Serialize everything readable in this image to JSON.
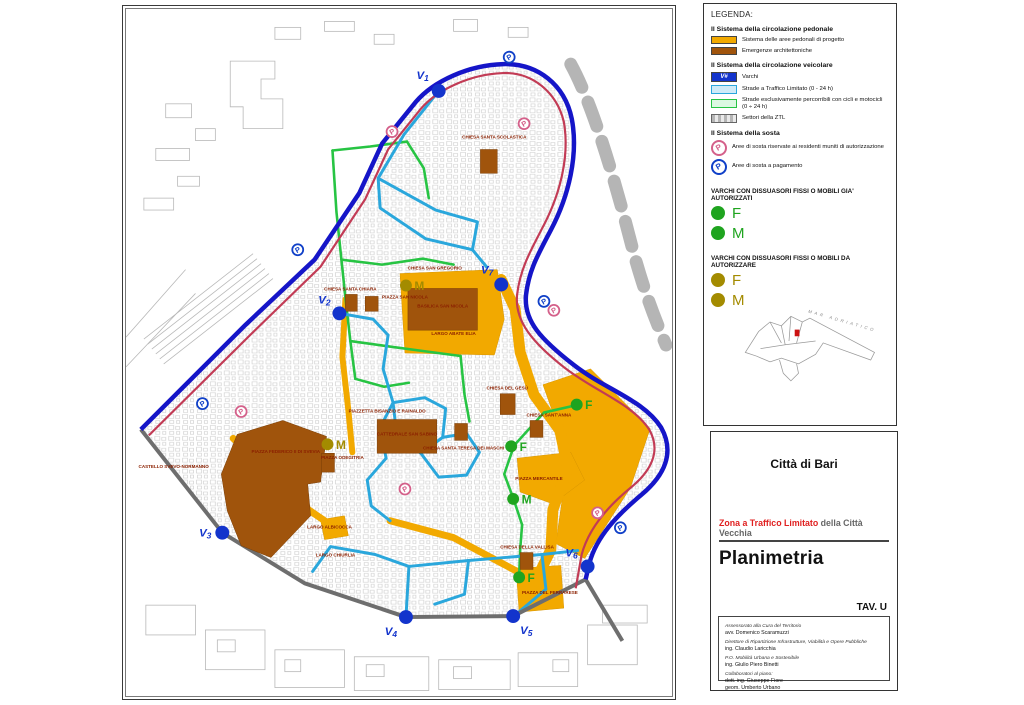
{
  "legend": {
    "title": "LEGENDA:",
    "sections": [
      {
        "heading": "Il Sistema della circolazione pedonale",
        "items": [
          {
            "swatch": "pedestrian-area",
            "label": "Sistema delle aree pedonali di progetto"
          },
          {
            "swatch": "architectural-emergency",
            "label": "Emergenze architettoniche"
          }
        ]
      },
      {
        "heading": "Il Sistema della circolazione veicolare",
        "items": [
          {
            "swatch": "varco",
            "glyph": "V#",
            "label": "Varchi"
          },
          {
            "swatch": "ztl-street",
            "label": "Strade a Traffico Limitato (0 - 24 h)"
          },
          {
            "swatch": "bike-street",
            "label": "Strade esclusivamente percorribili con cicli e motocicli (0 ÷ 24 h)"
          },
          {
            "swatch": "ztl-sector",
            "label": "Settori della ZTL"
          }
        ]
      },
      {
        "heading": "Il Sistema della sosta",
        "items": [
          {
            "swatch": "parking-residents",
            "glyph": "P",
            "label": "Aree di sosta riservate ai residenti muniti di autorizzazione"
          },
          {
            "swatch": "parking-paid",
            "glyph": "P",
            "label": "Aree di sosta a pagamento"
          }
        ]
      }
    ],
    "varchi_groups": [
      {
        "heading": "VARCHI CON DISSUASORI FISSI O MOBILI GIA' AUTORIZZATI",
        "status": "authorized",
        "entries": [
          "F",
          "M"
        ]
      },
      {
        "heading": "VARCHI CON DISSUASORI FISSI O MOBILI DA AUTORIZZARE",
        "status": "to_authorize",
        "entries": [
          "F",
          "M"
        ]
      }
    ],
    "inset_caption": "MAR ADRIATICO"
  },
  "title_block": {
    "city": "Città di Bari",
    "subtitle_red": "Zona a Traffico Limitato",
    "subtitle_rest": " della Città Vecchia",
    "title": "Planimetria",
    "sheet": "TAV. U",
    "credits": [
      {
        "role": "Assessorato alla Cura del Territorio",
        "name": "avv. Domenico Scaramuzzi"
      },
      {
        "role": "Direttore di Ripartizione Infrastrutture, Viabilità e Opere Pubbliche",
        "name": "ing. Claudio Laricchia"
      },
      {
        "role": "P.O. Mobilità Urbana e Sostenibile",
        "name": "ing. Giulio Piero Binetti"
      },
      {
        "role": "Collaboratori al piano:",
        "name": "dott. ing. Giuseppe Fiore\ngeom. Umberto Urbano"
      }
    ]
  },
  "map": {
    "colors": {
      "pedestrian": "#F2A900",
      "emergency": "#A0540C",
      "varco_blue": "#1334CC",
      "ztl_street": "#2AA7DC",
      "bike_street": "#27C443",
      "perimeter_blue": "#1515C8",
      "reserved_lane": "#C23B55",
      "sector_gray": "#6e6e6e",
      "authorized": "#1FA41F",
      "to_authorize": "#A38B00",
      "parking_residents": "#D4608A",
      "parking_paid": "#1040C8",
      "label_red": "#8B2000"
    },
    "labels": [
      {
        "t": "CHIESA SANTA SCOLASTICA",
        "x": 371,
        "y": 130
      },
      {
        "t": "CHIESA SAN GREGORIO",
        "x": 311,
        "y": 262
      },
      {
        "t": "PIAZZA SAN NICOLA",
        "x": 281,
        "y": 291
      },
      {
        "t": "BASILICA SAN NICOLA",
        "x": 319,
        "y": 300
      },
      {
        "t": "LARGO ABATE ELIA",
        "x": 330,
        "y": 328
      },
      {
        "t": "CHIESA SANTA CHIARA",
        "x": 226,
        "y": 283
      },
      {
        "t": "PIAZZETTA BISANZIO E RAINALDO",
        "x": 263,
        "y": 406
      },
      {
        "t": "CATTEDRALE SAN SABINO",
        "x": 283,
        "y": 429
      },
      {
        "t": "PIAZZA ODEGITRIA",
        "x": 218,
        "y": 453
      },
      {
        "t": "CHIESA SANTA TERESA DEI MASCHI",
        "x": 340,
        "y": 443
      },
      {
        "t": "CHIESA DEL GESÙ",
        "x": 384,
        "y": 383
      },
      {
        "t": "CHIESA SANT'ANNA",
        "x": 426,
        "y": 410
      },
      {
        "t": "PIAZZA MERCANTILE",
        "x": 416,
        "y": 474
      },
      {
        "t": "CHIESA DELLA VALLISA",
        "x": 404,
        "y": 543
      },
      {
        "t": "PIAZZA DEL FERRARESE",
        "x": 427,
        "y": 589
      },
      {
        "t": "CASTELLO SVEVO-NORMANNO",
        "x": 48,
        "y": 462
      },
      {
        "t": "PIAZZA FEDERICO II DI SVEVIA",
        "x": 161,
        "y": 447
      },
      {
        "t": "LARGO ALBICOCCA",
        "x": 205,
        "y": 523
      },
      {
        "t": "LARGO CHIURLIA",
        "x": 211,
        "y": 551
      }
    ],
    "varchi": [
      {
        "name": "V1",
        "x": 315,
        "y": 82,
        "lx": 305,
        "ly": 70,
        "anchor": "end"
      },
      {
        "name": "V2",
        "x": 215,
        "y": 306,
        "lx": 206,
        "ly": 296,
        "anchor": "end"
      },
      {
        "name": "V3",
        "x": 97,
        "y": 527,
        "lx": 86,
        "ly": 531,
        "anchor": "end"
      },
      {
        "name": "V4",
        "x": 282,
        "y": 612,
        "lx": 273,
        "ly": 630,
        "anchor": "end"
      },
      {
        "name": "V5",
        "x": 390,
        "y": 611,
        "lx": 397,
        "ly": 629,
        "anchor": "start"
      },
      {
        "name": "V6",
        "x": 465,
        "y": 561,
        "lx": 455,
        "ly": 551,
        "anchor": "end"
      },
      {
        "name": "V7",
        "x": 378,
        "y": 277,
        "lx": 370,
        "ly": 266,
        "anchor": "end"
      }
    ],
    "parking_residents": [
      [
        268,
        123
      ],
      [
        401,
        115
      ],
      [
        431,
        303
      ],
      [
        116,
        405
      ],
      [
        281,
        483
      ],
      [
        475,
        507
      ]
    ],
    "parking_paid": [
      [
        386,
        48
      ],
      [
        173,
        242
      ],
      [
        421,
        294
      ],
      [
        77,
        397
      ],
      [
        498,
        522
      ]
    ],
    "bollards": [
      {
        "letter": "F",
        "status": "authorized",
        "x": 454,
        "y": 398
      },
      {
        "letter": "F",
        "status": "authorized",
        "x": 388,
        "y": 440
      },
      {
        "letter": "M",
        "status": "authorized",
        "x": 390,
        "y": 493
      },
      {
        "letter": "F",
        "status": "authorized",
        "x": 396,
        "y": 572
      },
      {
        "letter": "M",
        "status": "to_authorize",
        "x": 282,
        "y": 278
      },
      {
        "letter": "M",
        "status": "to_authorize",
        "x": 203,
        "y": 438
      }
    ]
  }
}
